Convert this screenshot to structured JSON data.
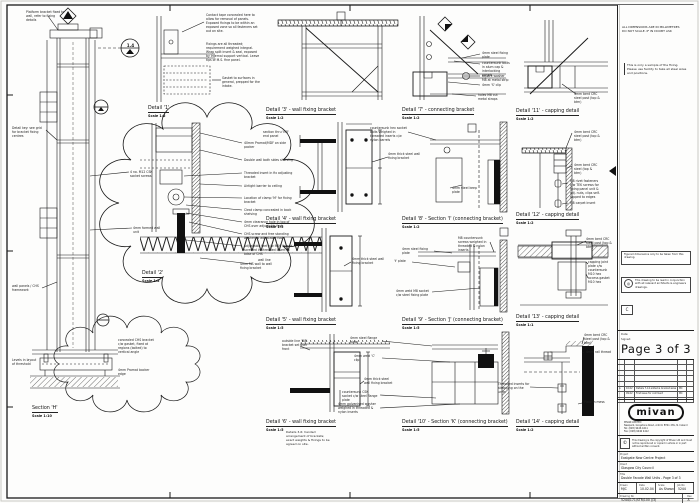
{
  "sheet_notes": {
    "dims_note_1": "ALL DIMENSIONS ARE IN MILLIMETRES",
    "dims_note_2": "DO NOT SCALE. IF IN DOUBT ASK",
    "sample_note": "This is only a sample of the fixing. Please use facility to take all steel sizes and positions."
  },
  "details": [
    {
      "title": "Detail '1'",
      "scale": "Scale  1:2",
      "x": 148,
      "y": 106
    },
    {
      "title": "Detail '2'",
      "scale": "Scale  1:2",
      "x": 142,
      "y": 271
    },
    {
      "title": "Detail '3' - wall fixing bracket",
      "scale": "Scale  1:2",
      "x": 266,
      "y": 108
    },
    {
      "title": "Detail '4' - wall fixing bracket",
      "scale": "Scale  1:5",
      "x": 266,
      "y": 217
    },
    {
      "title": "Detail '5' - wall fixing bracket",
      "scale": "Scale  1:5",
      "x": 266,
      "y": 318
    },
    {
      "title": "Detail '6' - wall fixing bracket",
      "scale": "Scale  1:5",
      "x": 266,
      "y": 420
    },
    {
      "title": "Detail '7' - connecting bracket",
      "scale": "Scale  1:2",
      "x": 402,
      "y": 108
    },
    {
      "title": "Detail '8' - Section 'I' (connecting bracket)",
      "scale": "Scale  1:2",
      "x": 402,
      "y": 217
    },
    {
      "title": "Detail '9' - Section 'J' (connecting bracket)",
      "scale": "Scale  1:5",
      "x": 402,
      "y": 318
    },
    {
      "title": "Detail '10' - Section 'K' (connecting bracket)",
      "scale": "Scale  1:5",
      "x": 402,
      "y": 420
    },
    {
      "title": "Detail '11' - capping detail",
      "scale": "Scale  1:2",
      "x": 516,
      "y": 109
    },
    {
      "title": "Detail '12' - capping detail",
      "scale": "Scale  1:2",
      "x": 516,
      "y": 213
    },
    {
      "title": "Detail '13' - capping detail",
      "scale": "Scale  1:1",
      "x": 516,
      "y": 315
    },
    {
      "title": "Detail '14' - capping detail",
      "scale": "Scale  1:2",
      "x": 516,
      "y": 420
    },
    {
      "title": "Section 'H'",
      "scale": "Scale  1:10",
      "x": 32,
      "y": 406
    }
  ],
  "annotations": [
    {
      "x": 26,
      "y": 10,
      "w": 40,
      "text": "Platform bracket fixed to wall, refer to fixing details"
    },
    {
      "x": 12,
      "y": 126,
      "w": 34,
      "text": "Detail key: see grid for bracket fixing centres"
    },
    {
      "x": 130,
      "y": 170,
      "w": 30,
      "text": "4 no. M12 CSK socket screws"
    },
    {
      "x": 133,
      "y": 226,
      "w": 30,
      "text": "4mm formed wall unit"
    },
    {
      "x": 12,
      "y": 284,
      "w": 30,
      "text": "wall panels / CHS framework"
    },
    {
      "x": 12,
      "y": 358,
      "w": 26,
      "text": "Levels in layout of threshold"
    },
    {
      "x": 118,
      "y": 338,
      "w": 38,
      "text": "concealed CHS bracket c/w gasket, fixed at regions (bolted) to vertical angle"
    },
    {
      "x": 118,
      "y": 368,
      "w": 36,
      "text": "4mm Promat backer edge"
    },
    {
      "x": 124,
      "y": 43,
      "w": 13,
      "text": "1.4",
      "center": true,
      "size": 4.2
    },
    {
      "x": 206,
      "y": 13,
      "w": 54,
      "text": "Contact tape concealed here to allow for removal of panels. Exposed fixings to be within an exposed zone so all fasteners set out on site."
    },
    {
      "x": 206,
      "y": 42,
      "w": 54,
      "text": "Fixings are all threaded; requirement weighed integral. Wrap split insert & seal, exposed by internal support vertical. Leave tips of M.S. fine panel."
    },
    {
      "x": 222,
      "y": 76,
      "w": 42,
      "text": "Gasket to surfaces in general, prepped for the intake."
    },
    {
      "x": 244,
      "y": 141,
      "w": 50,
      "text": "40mm Promat/MDF on side packer"
    },
    {
      "x": 244,
      "y": 158,
      "w": 50,
      "text": "Double wall both sides shelving"
    },
    {
      "x": 244,
      "y": 171,
      "w": 50,
      "text": "Threaded insert in fix adjusting bracket"
    },
    {
      "x": 244,
      "y": 184,
      "w": 50,
      "text": "Airtight barrier to ceiling"
    },
    {
      "x": 244,
      "y": 196,
      "w": 50,
      "text": "Location of clamp 'M' for fixing bracket"
    },
    {
      "x": 244,
      "y": 208,
      "w": 50,
      "text": "Cleat clamp concealed in back shelving"
    },
    {
      "x": 244,
      "y": 220,
      "w": 50,
      "text": "4mm clearance hole in top of CHS over adjustable foot"
    },
    {
      "x": 244,
      "y": 232,
      "w": 50,
      "text": "CHS screw and free standing washer to adjustable foot"
    },
    {
      "x": 244,
      "y": 244,
      "w": 50,
      "text": "Adjustable feet c/w M16 thread screwed in threaded insert to base of CHS"
    },
    {
      "x": 240,
      "y": 262,
      "w": 40,
      "text": "4mm MS wall to wall fixing bracket"
    },
    {
      "x": 263,
      "y": 130,
      "w": 30,
      "text": "section thru 'M8' end panel"
    },
    {
      "x": 388,
      "y": 152,
      "w": 34,
      "text": "4mm thick steel wall fixing bracket"
    },
    {
      "x": 352,
      "y": 257,
      "w": 34,
      "text": "4mm thick steel wall fixing bracket"
    },
    {
      "x": 258,
      "y": 258,
      "w": 14,
      "text": "wall line"
    },
    {
      "x": 282,
      "y": 339,
      "w": 32,
      "text": "outside line 'M8' bracket set over front"
    },
    {
      "x": 364,
      "y": 377,
      "w": 30,
      "text": "4mm thick steel wall fixing bracket"
    },
    {
      "x": 286,
      "y": 431,
      "w": 46,
      "text": "Details 3-6: handed arrangement of brackets; exact weights & fixings to be agreed on site.",
      "size": 3
    },
    {
      "x": 482,
      "y": 51,
      "w": 28,
      "text": "4mm steel fixing plate"
    },
    {
      "x": 482,
      "y": 61,
      "w": 28,
      "text": "countersunk bolts in alum cap & interlocking panels"
    },
    {
      "x": 482,
      "y": 74,
      "w": 28,
      "text": "square washer M8 at metal strip"
    },
    {
      "x": 482,
      "y": 83,
      "w": 26,
      "text": "4mm 'S' clip"
    },
    {
      "x": 478,
      "y": 93,
      "w": 28,
      "text": "holes M8 cut metal straps"
    },
    {
      "x": 370,
      "y": 126,
      "w": 38,
      "text": "countersunk hex socket bolts weighed in threaded inserts c/w nylon barrels"
    },
    {
      "x": 452,
      "y": 186,
      "w": 28,
      "text": "4mm steel keep plate"
    },
    {
      "x": 402,
      "y": 247,
      "w": 28,
      "text": "4mm steel fixing plate"
    },
    {
      "x": 394,
      "y": 259,
      "w": 18,
      "text": "'t' plate"
    },
    {
      "x": 396,
      "y": 289,
      "w": 34,
      "text": "4mm weld M8 socket c/w steel fixing plate"
    },
    {
      "x": 458,
      "y": 236,
      "w": 32,
      "text": "M8 countersunk screws weighed in threaded & nylon inserts"
    },
    {
      "x": 350,
      "y": 336,
      "w": 30,
      "text": "4mm steel flange plate"
    },
    {
      "x": 354,
      "y": 354,
      "w": 26,
      "text": "4mm weld 'C' clip"
    },
    {
      "x": 342,
      "y": 390,
      "w": 36,
      "text": "countersunk CSK socket c/w steel flange plate"
    },
    {
      "x": 338,
      "y": 402,
      "w": 40,
      "text": "4mm galvanised washer weighed in threaded & nylon inserts"
    },
    {
      "x": 574,
      "y": 92,
      "w": 26,
      "text": "4mm bent CRC steel post (top & btm)"
    },
    {
      "x": 574,
      "y": 130,
      "w": 26,
      "text": "4mm bent CRC steel post (top & btm)"
    },
    {
      "x": 574,
      "y": 163,
      "w": 26,
      "text": "4mm bent CRC steel (top & btm)"
    },
    {
      "x": 570,
      "y": 179,
      "w": 30,
      "text": "M8 rivet fasteners c/w TEK screws for fixing panel unit & adj. nuts, clips self-tapped to edges"
    },
    {
      "x": 570,
      "y": 201,
      "w": 26,
      "text": "M8 carpet insert"
    },
    {
      "x": 586,
      "y": 237,
      "w": 26,
      "text": "4mm bent CRC steel post (top & btm)"
    },
    {
      "x": 588,
      "y": 260,
      "w": 26,
      "text": "capping joint plate c/w countersunk M10 hex"
    },
    {
      "x": 588,
      "y": 276,
      "w": 26,
      "text": "access gasket M10 hex"
    },
    {
      "x": 584,
      "y": 333,
      "w": 26,
      "text": "4mm bent CRC steel post (top & btm)"
    },
    {
      "x": 586,
      "y": 350,
      "w": 26,
      "text": "4mm rail thread"
    },
    {
      "x": 498,
      "y": 382,
      "w": 32,
      "text": "Threaded inserts for strapping on the units"
    },
    {
      "x": 584,
      "y": 400,
      "w": 26,
      "text": "Plate in mess"
    }
  ],
  "panel": {
    "note_dims_1": "ALL DIMENSIONS ARE IN MILLIMETRES",
    "note_dims_2": "DO NOT SCALE. IF IN DOUBT ASK",
    "note_sample": "This is only a sample of the fixing. Please use facility to take all steel sizes and positions.",
    "note_figured": "Figured dimensions only to be taken from this drawing.",
    "note_read": "This drawing to be read in conjunction with all relevant architects & engineers drawings.",
    "status_letter": "C",
    "date_label": "Date:",
    "signed_label": "Signed:",
    "page_label": "Page 3 of 3",
    "logo_text": "mivan",
    "company_name": "MIVAN LIMITED",
    "company_address": "Newpark, Greystone Road, Antrim BT41 2SS, N. Ireland",
    "company_tel": "Tel: (028) 9446 4411",
    "company_fax": "Fax: (028) 9446 4412",
    "copyright_symbol": "©",
    "copyright_note": "This drawing is the copyright of Mivan Ltd and must not be reproduced or copied in whole or in part without written consent.",
    "project_label": "Project",
    "project": "Eastgate New Centre Project",
    "client_label": "Client",
    "client": "Glasgow City Council",
    "title_label": "Title",
    "drawing_title": "Double Facade Wall Units - Page 3 of 3",
    "drawn_label": "Drawn",
    "drawn": "MJC",
    "date_field_label": "Date",
    "date": "10.02.04",
    "scale_label": "Scale",
    "scale": "As Shown",
    "job_label": "Job No",
    "job": "5244",
    "dwg_label": "Drawing No",
    "dwg_no": "5244/171/STR/100 (/3)",
    "rev_label": "Rev",
    "rev": "A",
    "revisions": [
      {
        "rev": "",
        "date": "",
        "desc": "",
        "by": ""
      },
      {
        "rev": "",
        "date": "",
        "desc": "",
        "by": ""
      },
      {
        "rev": "",
        "date": "",
        "desc": "",
        "by": ""
      },
      {
        "rev": "",
        "date": "",
        "desc": "",
        "by": ""
      },
      {
        "rev": "",
        "date": "",
        "desc": "",
        "by": ""
      },
      {
        "rev": "A",
        "date": "10.02",
        "desc": "Details 7-14 added & bracket sizes revised",
        "by": "MC"
      },
      {
        "rev": "-",
        "date": "09.02",
        "desc": "First issue for comment",
        "by": "MC"
      },
      {
        "rev": "",
        "date": "",
        "desc": "",
        "by": ""
      }
    ]
  }
}
